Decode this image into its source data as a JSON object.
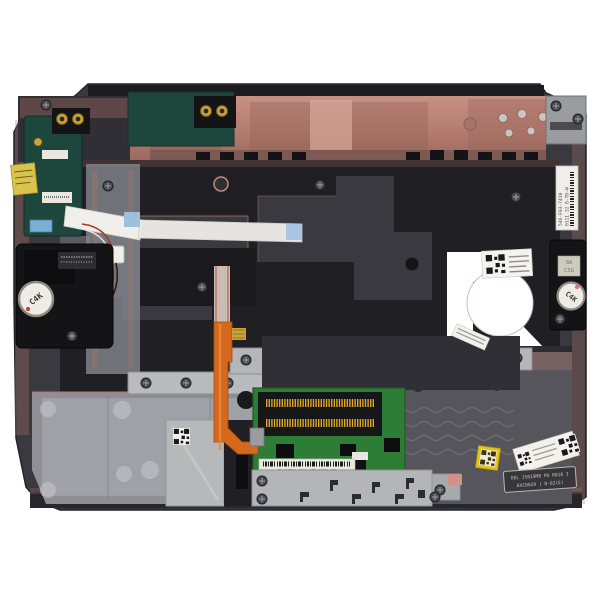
{
  "image": {
    "description": "Top-down product photo of a laptop palmrest assembly (inside/bottom view) with touchpad circuit board, speakers, flex cables and service stickers on a white background",
    "background_color": "#ffffff"
  },
  "palette": {
    "body_dark": "#3a3940",
    "frame_black": "#202024",
    "copper_tint": "#bc8173",
    "panel_gray": "#97979c",
    "metal_gray": "#b7b9bc",
    "pcb_green": "#2e7d36",
    "pcb_teal": "#1d473c",
    "flex_orange": "#d4681c",
    "wire_red": "#b22a20",
    "sticker_yellow": "#e3c419",
    "label_white": "#e9e7e0"
  },
  "stickers": {
    "c4k": "C4K",
    "badge_line1": "8A",
    "badge_line2": "C5G",
    "side_label_line1": "546-F03-7419",
    "side_label_line2": "0111 32 B-TD-W",
    "touchpad_label": "CN-0KTX1-1261-05T-J2K7-A00",
    "engraved_line1": "DEL JS019M0 PD R018 I",
    "engraved_line2": "KXCB029 | B-02(E)"
  },
  "parts": [
    "palmrest-body",
    "back-edge-copper-band",
    "left-io-board",
    "audio-jack-connectors",
    "left-speaker",
    "right-speaker",
    "touchpad-board",
    "touchpad-shield-plate",
    "touchpad-bracket",
    "orange-flex-cable",
    "white-ribbon-cable",
    "power-wire-connector",
    "metal-bracket-row",
    "qr-service-stickers",
    "side-barcode-label"
  ]
}
